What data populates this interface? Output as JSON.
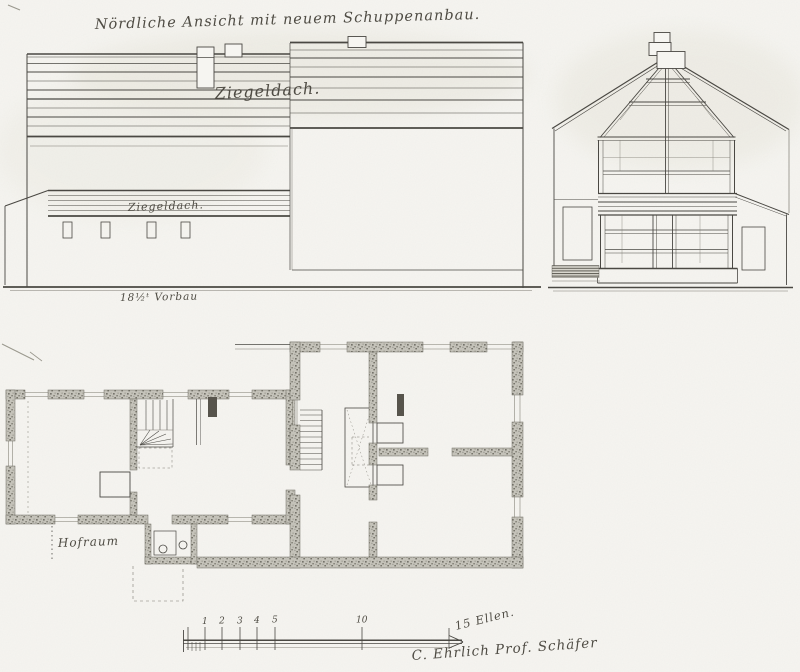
{
  "title": "Nördliche Ansicht mit neuem Schuppenanbau.",
  "elevation": {
    "roof_label_main": "Ziegeldach.",
    "roof_label_shed": "Ziegeldach.",
    "note": "18½ᵗ Vorbau"
  },
  "plan": {
    "courtyard_label": "Hofraum"
  },
  "scale_bar": {
    "ticks": [
      "1",
      "2",
      "3",
      "4",
      "5",
      "10"
    ],
    "unit_label": "15 Ellen."
  },
  "signature": "C. Ehrlich Prof. Schäfer",
  "colors": {
    "paper": "#f6f5f1",
    "ink": "#4a4843",
    "pencil": "#9a988e",
    "wall_stipple": "#b7b5ac"
  }
}
